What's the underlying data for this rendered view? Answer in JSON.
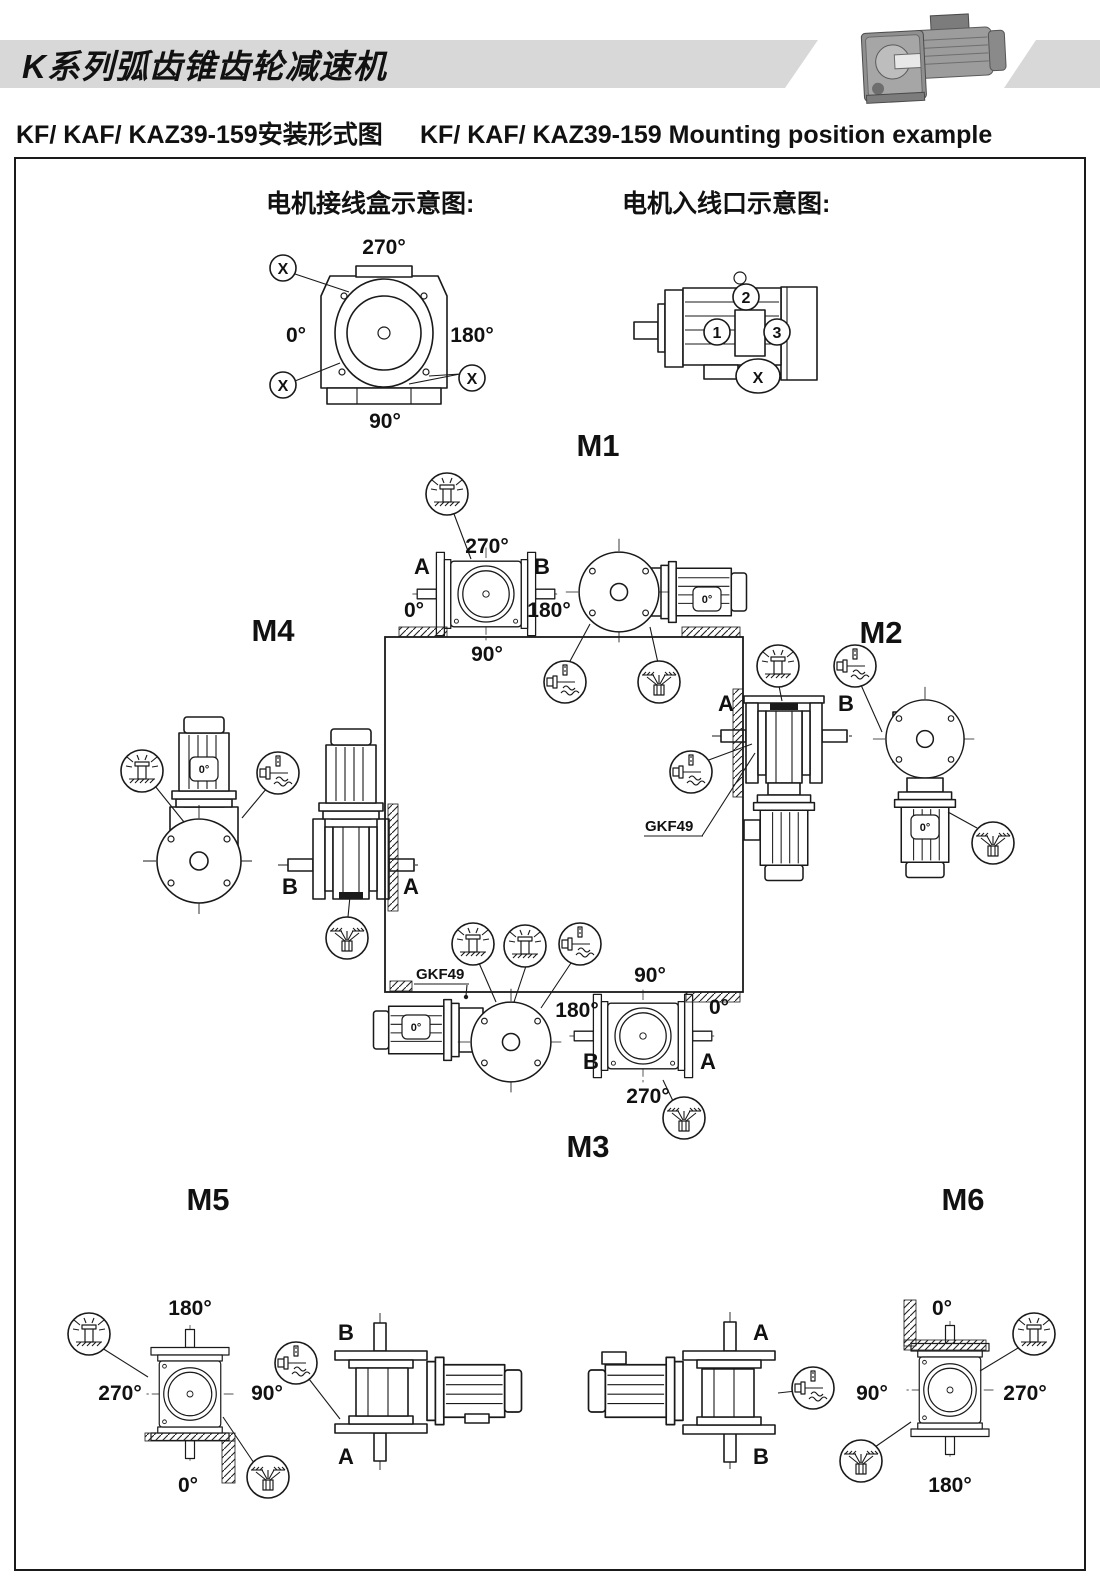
{
  "header": {
    "series_title": "K系列弧齿锥齿轮减速机",
    "title_cn": "KF/ KAF/ KAZ39-159安装形式图",
    "title_en": "KF/ KAF/ KAZ39-159 Mounting position example"
  },
  "colors": {
    "band_gray": "#d8d8d8",
    "line": "#1a1a1a"
  },
  "legend": {
    "terminal_box_title": "电机接线盒示意图:",
    "cable_entry_title": "电机入线口示意图:",
    "marker": "X",
    "terminal_angles": {
      "top": "270°",
      "left": "0°",
      "right": "180°",
      "bottom": "90°"
    },
    "entry_points": {
      "p1": "1",
      "p2": "2",
      "p3": "3"
    }
  },
  "motor_mark": "0°",
  "mounts": {
    "m1": {
      "label": "M1",
      "angle_top": "270°",
      "angle_left": "0°",
      "angle_right": "180°",
      "angle_bottom": "90°",
      "port_left": "A",
      "port_right": "B"
    },
    "m2": {
      "label": "M2",
      "port_left": "A",
      "port_right": "B",
      "callout": "GKF49"
    },
    "m3": {
      "label": "M3",
      "angle_top": "90°",
      "angle_left": "180°",
      "angle_right": "0°",
      "angle_bottom": "270°",
      "port_left": "B",
      "port_right": "A",
      "callout": "GKF49"
    },
    "m4": {
      "label": "M4",
      "port_left": "B",
      "port_right": "A"
    },
    "m5": {
      "label": "M5",
      "angle_top": "180°",
      "angle_left": "270°",
      "angle_right": "90°",
      "angle_bottom": "0°",
      "port_top": "B",
      "port_bottom": "A"
    },
    "m6": {
      "label": "M6",
      "angle_top": "0°",
      "angle_left": "90°",
      "angle_right": "270°",
      "angle_bottom": "180°",
      "port_top": "A",
      "port_bottom": "B"
    }
  }
}
